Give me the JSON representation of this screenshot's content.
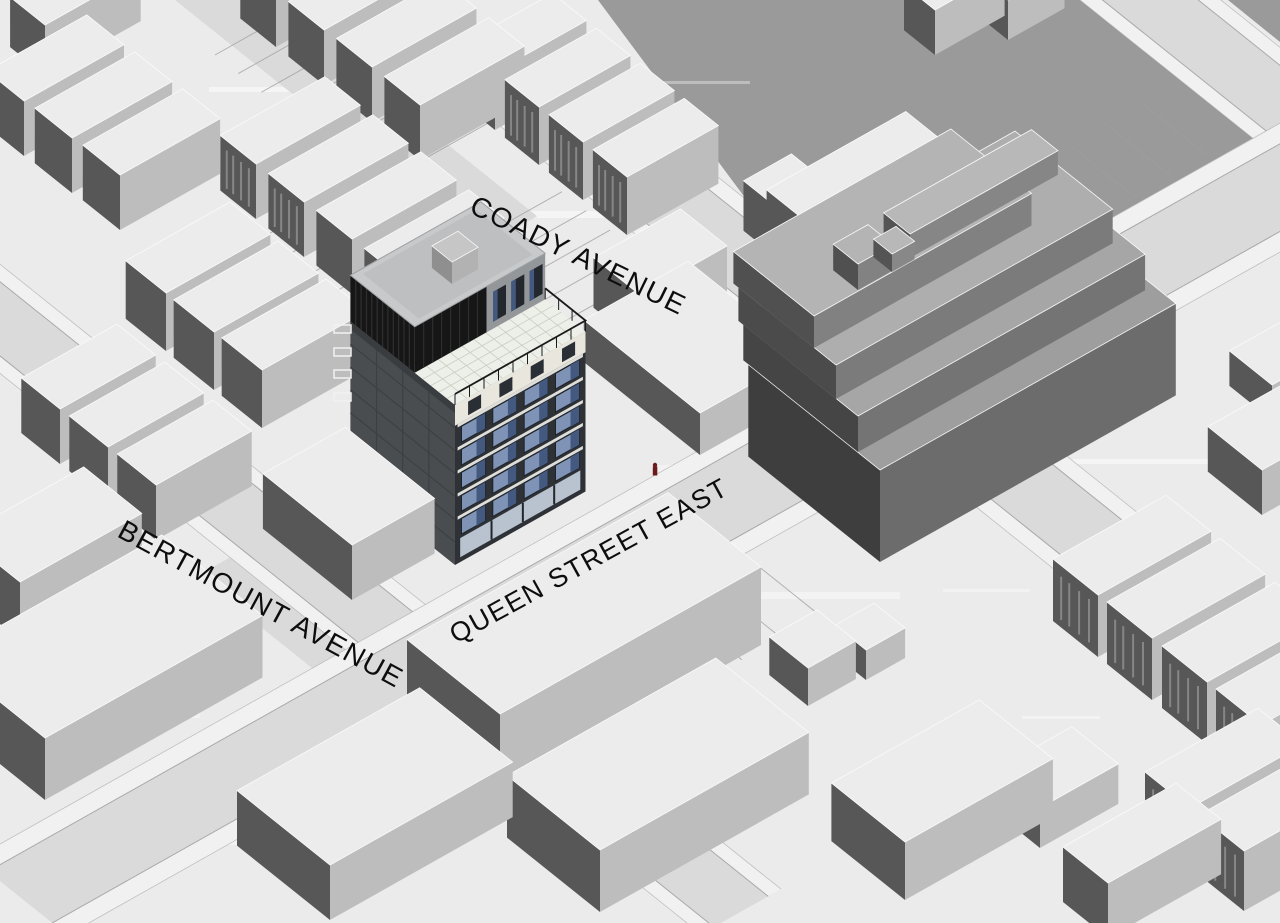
{
  "scene": {
    "kind": "axonometric-site-plan",
    "labels": {
      "coady": "COADY AVENUE",
      "bertmount": "BERTMOUNT AVENUE",
      "queen": "QUEEN STREET EAST"
    },
    "marker": {
      "color": "#6b1b1b"
    },
    "palette": {
      "ground": "#ebebeb",
      "street": "#dadada",
      "sidewalk": "#f1f1f1",
      "curb": "#a3a3a3",
      "open_area": "#9a9a9a",
      "massing_top": "#ececec",
      "massing_shadow_side": "#575757",
      "massing_lit_side": "#bdbdbd",
      "stepped_top": "#9e9e9e",
      "stepped_shadow": "#3e3e3e",
      "stepped_lit": "#6c6c6c",
      "proposal_facade": "#2e3236",
      "proposal_panel": "#4a4d4f",
      "proposal_glass": "#7f93b7",
      "proposal_glass_dark": "#44597f",
      "proposal_white": "#e9e7dd",
      "proposal_louver": "#161616",
      "proposal_upper_wall": "#94979a",
      "proposal_roof": "#c7c9cb",
      "terrace_floor": "#edefe9",
      "label_color": "#0d0d0d"
    }
  }
}
